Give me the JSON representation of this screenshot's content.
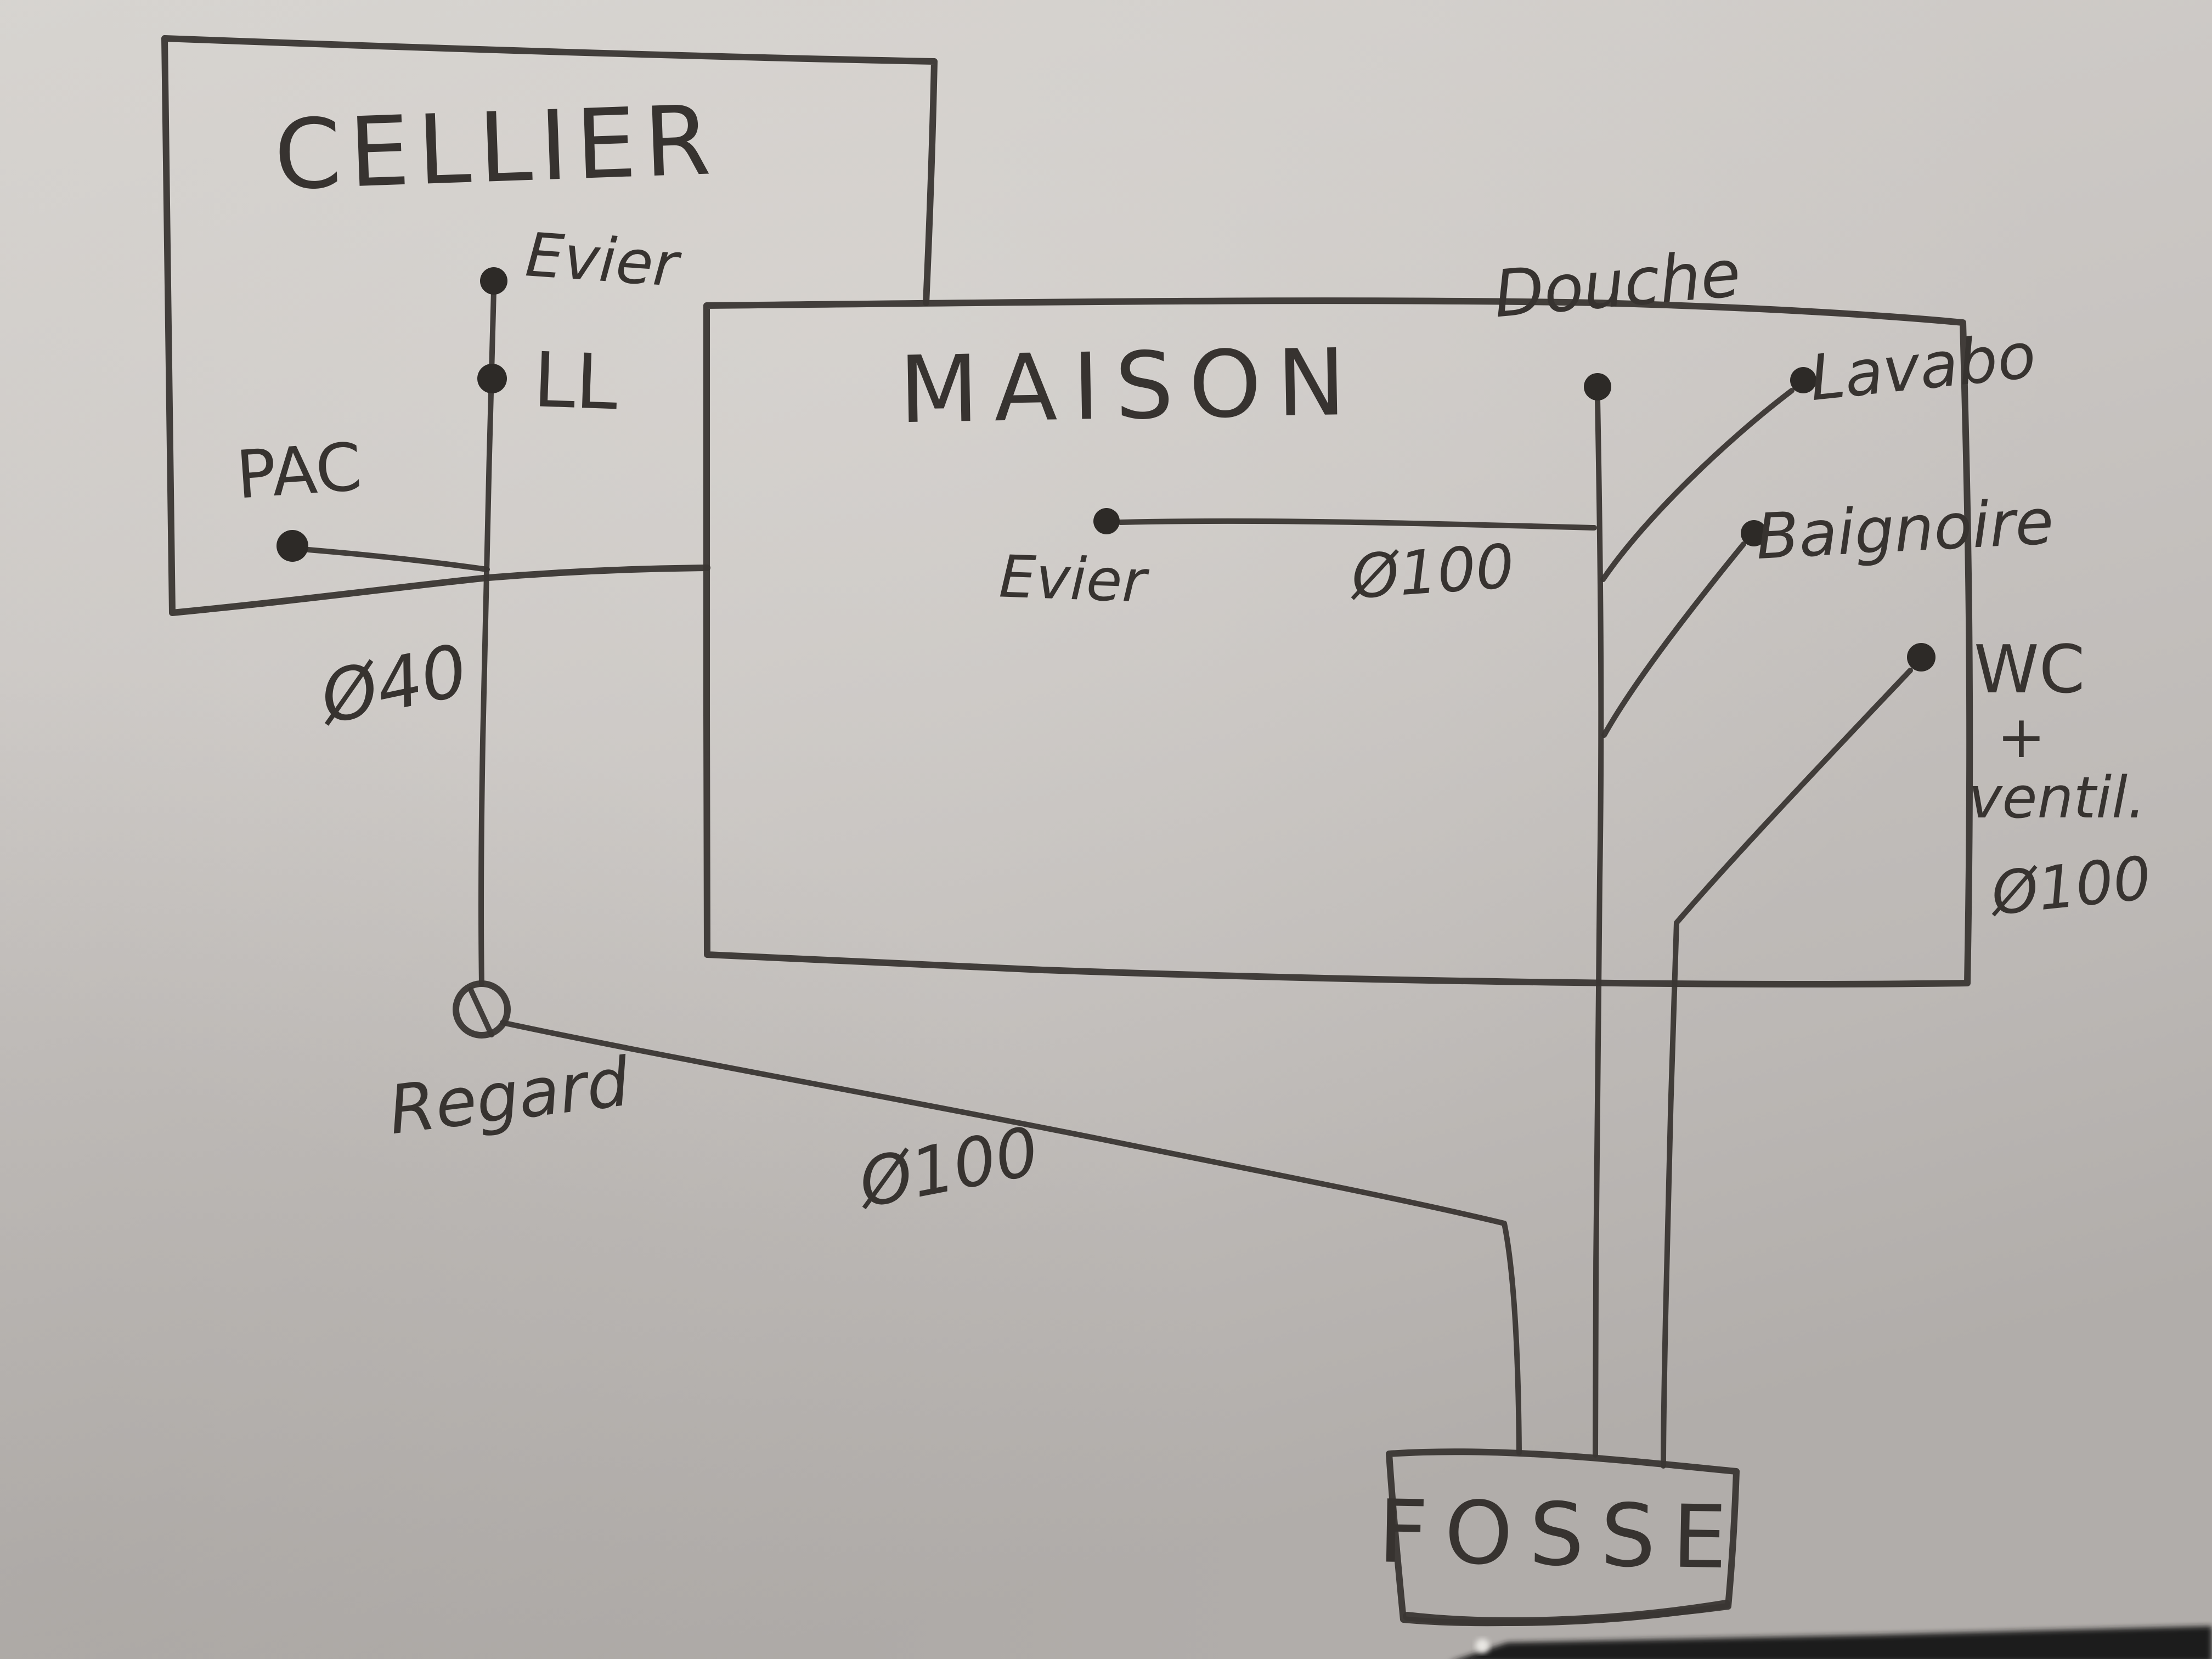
{
  "colors": {
    "paper": "#c8c4c1",
    "ink": "#3a3633",
    "table_edge": "#1f1c1a"
  },
  "rooms": {
    "cellier": "CELLIER",
    "maison": "MAISON",
    "fosse": "FOSSE"
  },
  "cellier": {
    "evier": "Evier",
    "lave_linge": "LL",
    "pac": "PAC"
  },
  "maison": {
    "evier": "Evier",
    "douche": "Douche",
    "lavabo": "Lavabo",
    "baignoire": "Baignoire",
    "wc": [
      "WC",
      "+",
      "ventil.",
      "Ø100"
    ]
  },
  "pipes": {
    "cellier_drain": "Ø40",
    "evier_drain": "Ø100",
    "main_drain": "Ø100"
  },
  "network": {
    "regard": "Regard"
  }
}
